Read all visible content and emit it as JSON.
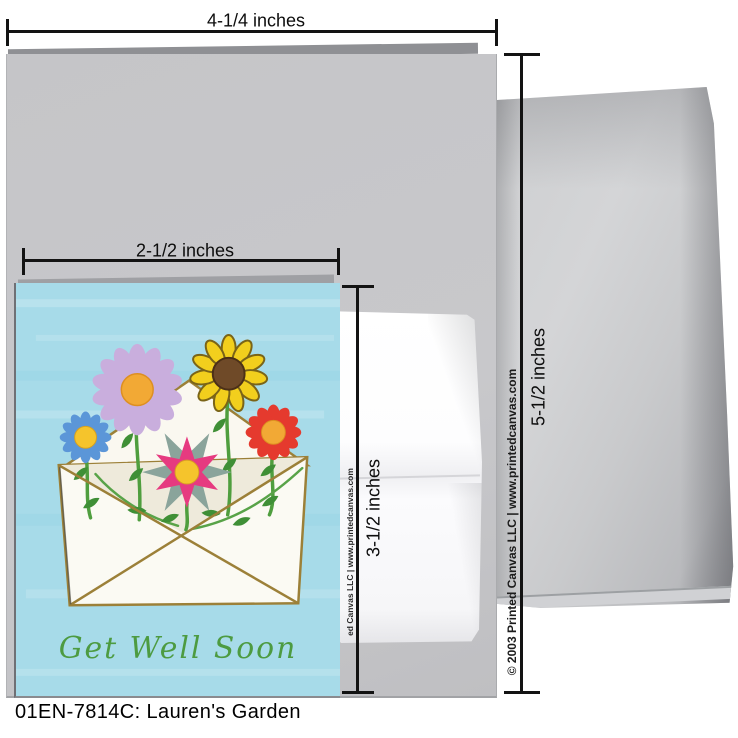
{
  "caption": "01EN-7814C: Lauren's Garden",
  "card": {
    "greeting": "Get Well Soon"
  },
  "measurements": {
    "large_card_width": "4-1/4 inches",
    "large_card_height": "5-1/2 inches",
    "small_card_width": "2-1/2 inches",
    "small_card_height": "3-1/2 inches"
  },
  "copyright": {
    "envelope_strip": "© 2003 Printed Canvas LLC | www.printedcanvas.com",
    "card_strip": "ed Canvas LLC | www.printedcanvas.com"
  },
  "colors": {
    "sky": "#a7dbe9",
    "greeting_green": "#4d9b41",
    "envelope_tan": "#9c8038",
    "stem_green": "#4f9e3e",
    "daisy_lavender": "#c9aedd",
    "daisy_blue": "#5b96d8",
    "daisy_red": "#e53a2e",
    "sunflower_yellow": "#f2cf1d",
    "sunflower_outline": "#7a6418",
    "sunflower_brown": "#6f4a28",
    "star_pink": "#e63a80",
    "star_sepal": "#8aa49b",
    "center_orange": "#f2a935",
    "center_yellow": "#f5c42c",
    "large_card_gray": "#c5c5c8",
    "envelope_gray": "#c6c7c9"
  }
}
